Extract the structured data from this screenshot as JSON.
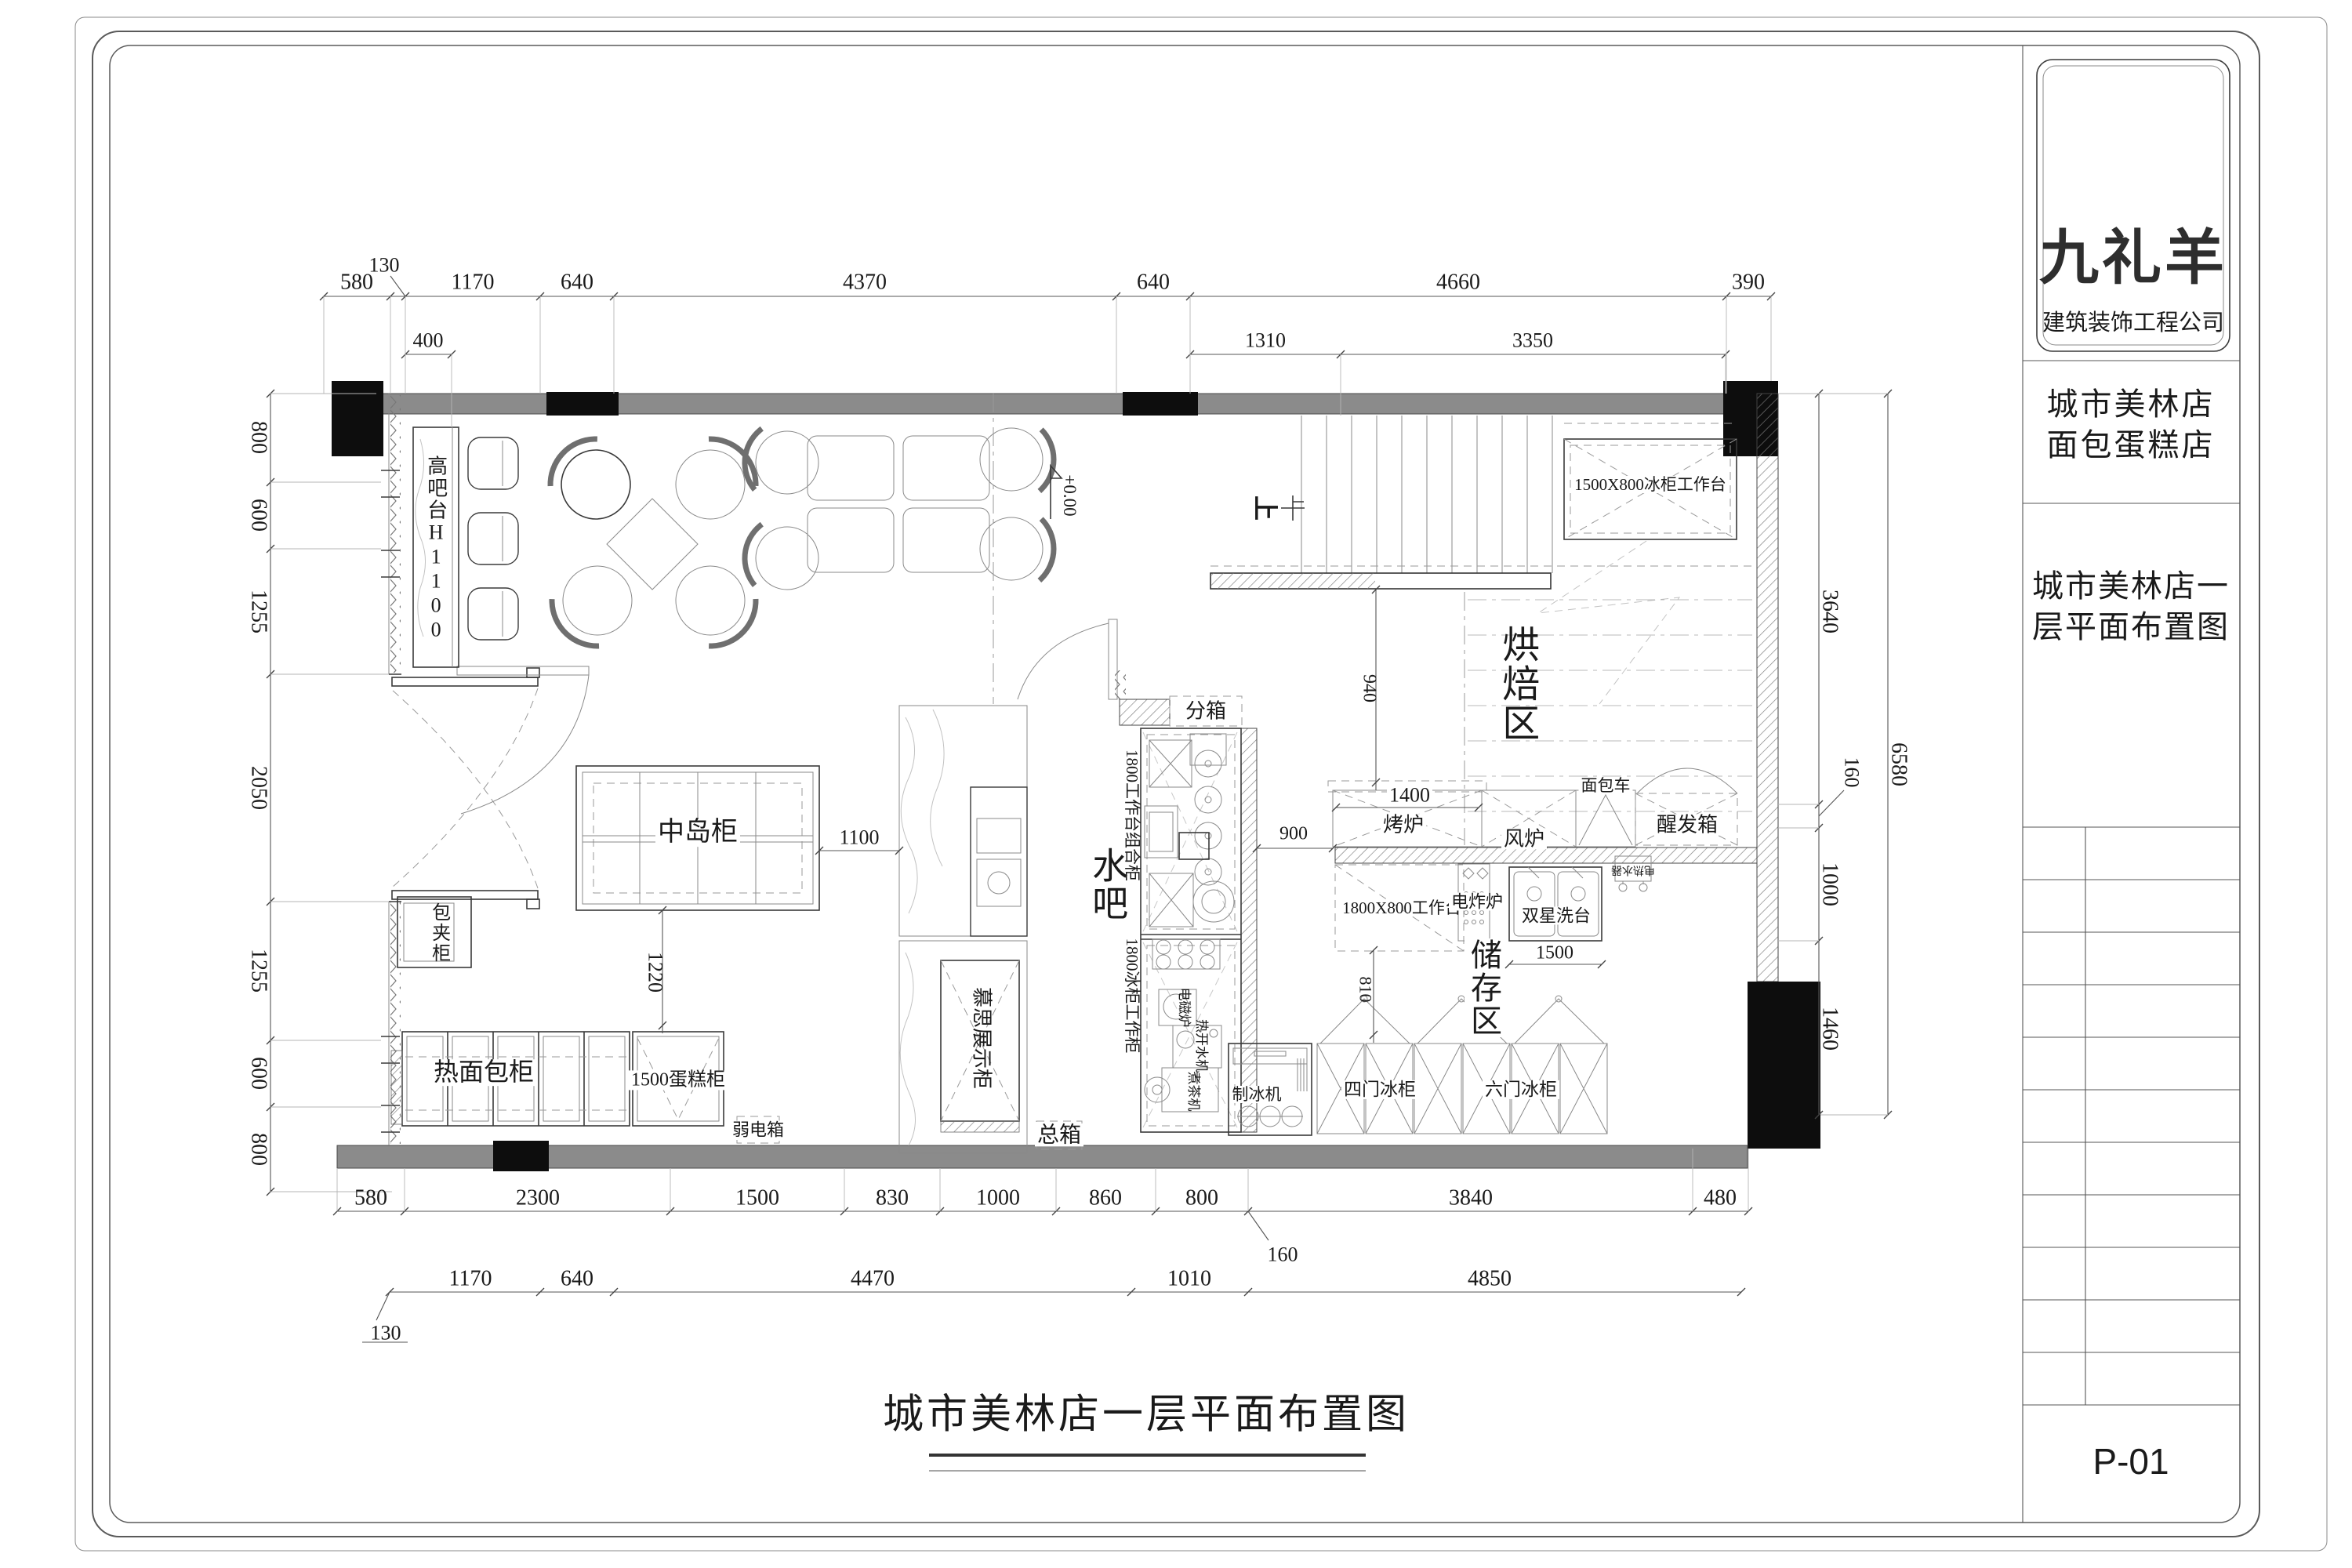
{
  "titleblock": {
    "brand": "九礼羊",
    "company": "建筑装饰工程公司",
    "project_line1": "城市美林店",
    "project_line2": "面包蛋糕店",
    "title_line1": "城市美林店一",
    "title_line2": "层平面布置图",
    "sheet_number": "P-01"
  },
  "caption": "城市美林店一层平面布置图",
  "zones": {
    "baking": "烘焙区",
    "storage": "储存区",
    "waterbar": "水吧"
  },
  "labels": {
    "high_bar": "高吧台H1100",
    "island": "中岛柜",
    "mousse": "慕思展示柜",
    "bag_cabinet": "包夹柜",
    "hot_bread": "热面包柜",
    "cake": "1500蛋糕柜",
    "lv_box": "弱电箱",
    "main_box": "总箱",
    "sub_box": "分箱",
    "combo": "1800工作台组合柜",
    "freezer_work": "1800冰柜工作柜",
    "induction": "电磁炉",
    "water_boiler": "热开水机",
    "tea_machine": "煮茶机",
    "ice_machine": "制冰机",
    "fridge4": "四门冰柜",
    "fridge6": "六门冰柜",
    "table1800": "1800X800工作台",
    "fryer": "电炸炉",
    "double_sink": "双星洗台",
    "water_heater": "电热水器",
    "oven": "烤炉",
    "fan_oven": "风炉",
    "bread_cart": "面包车",
    "proofer": "醒发箱",
    "freezer_table": "1500X800冰柜工作台",
    "level": "+0.00",
    "up": "上"
  },
  "dims": {
    "top_row1": [
      "580",
      "130",
      "1170",
      "640",
      "4370",
      "640",
      "4660",
      "390"
    ],
    "top_row2": [
      "400",
      "1310",
      "3350"
    ],
    "left": [
      "800",
      "600",
      "1255",
      "2050",
      "1255",
      "600",
      "800"
    ],
    "right": [
      "3640",
      "160",
      "1000",
      "1460"
    ],
    "right_total": "6580",
    "bottom_row1": [
      "580",
      "2300",
      "1500",
      "830",
      "1000",
      "860",
      "800",
      "3840",
      "480"
    ],
    "bottom_offset": "160",
    "bottom_row2": [
      "1170",
      "640",
      "4470",
      "1010",
      "4850"
    ],
    "bottom_offset2": "130",
    "interior": {
      "island_side": "1100",
      "island_below": "1220",
      "bake_left": "940",
      "bake_pass": "900",
      "oven_w": "1400",
      "sink_w": "1500",
      "storage_left": "810"
    }
  }
}
